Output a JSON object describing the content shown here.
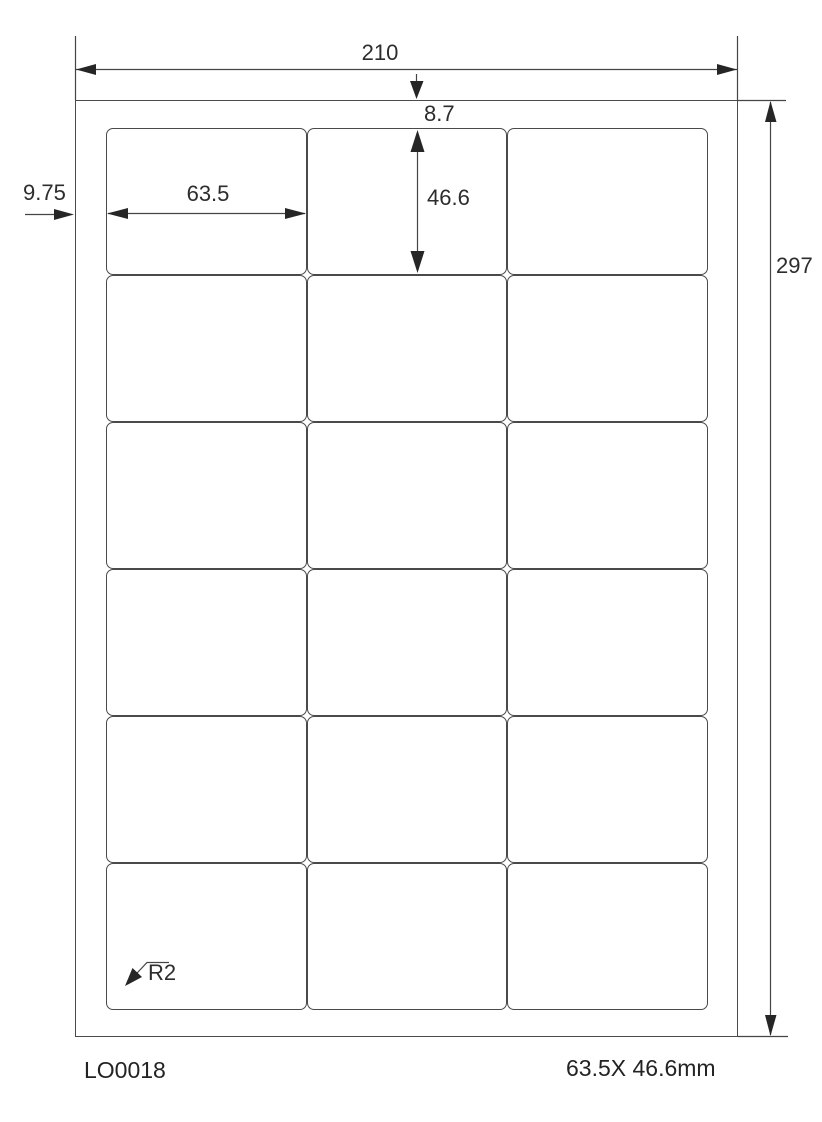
{
  "diagram": {
    "title_meaning": "label-sheet-dimension-drawing",
    "dimensions": {
      "page_width": "210",
      "page_height": "297",
      "top_margin": "8.7",
      "left_margin": "9.75",
      "label_width": "63.5",
      "label_height": "46.6",
      "corner_radius": "R2"
    },
    "grid": {
      "columns": 3,
      "rows": 6,
      "label_count": 18
    },
    "footer": {
      "product_code": "LO0018",
      "label_size": "63.5X 46.6mm"
    },
    "colors": {
      "background": "#ffffff",
      "line": "#4a4a4a",
      "arrow": "#262626",
      "text": "#2d2d2d"
    }
  }
}
